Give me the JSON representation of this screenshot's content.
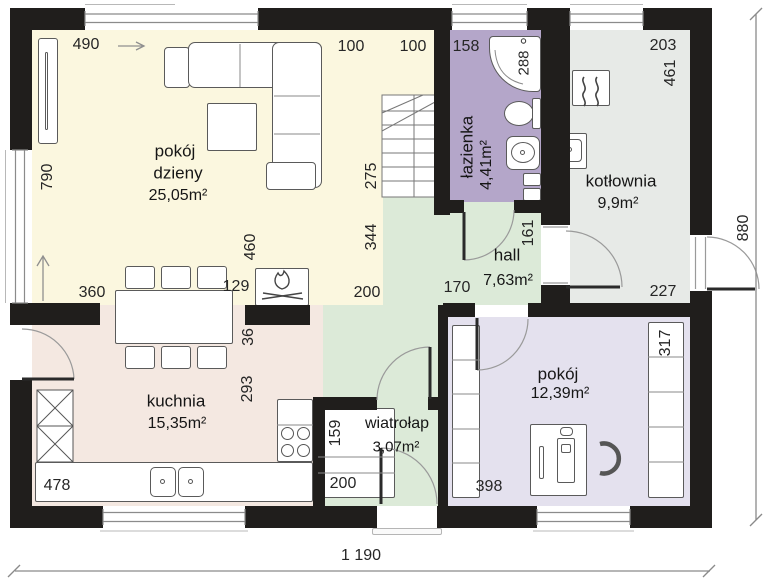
{
  "colors": {
    "wall": "#201e1c",
    "living": "#fbf7df",
    "kitchen": "#f4e8e1",
    "hall": "#dcead8",
    "vestibule": "#dcead8",
    "bathroom": "#b4a6c9",
    "boiler_room": "#e7eae7",
    "bedroom": "#e4e1ee",
    "furniture_outline": "#5a5a5a"
  },
  "rooms": {
    "living": {
      "name_line1": "pokój",
      "name_line2": "dzieny",
      "area": "25,05m²"
    },
    "kitchen": {
      "name": "kuchnia",
      "area": "15,35m²"
    },
    "bathroom": {
      "name": "łazienka",
      "area": "4,41m²"
    },
    "boiler_room": {
      "name": "kotłownia",
      "area": "9,9m²"
    },
    "hall": {
      "name": "hall",
      "area": "7,63m²"
    },
    "vestibule": {
      "name": "wiatrołap",
      "area": "3,07m²"
    },
    "bedroom": {
      "name": "pokój",
      "area": "12,39m²"
    }
  },
  "dimensions": {
    "d490": "490",
    "d790": "790",
    "d100a": "100",
    "d100b": "100",
    "d158": "158",
    "d288": "288",
    "d203": "203",
    "d461": "461",
    "d275": "275",
    "d344": "344",
    "d460": "460",
    "d129": "129",
    "d360": "360",
    "d200_hall": "200",
    "d161": "161",
    "d880": "880",
    "d227": "227",
    "d170": "170",
    "d36": "36",
    "d293": "293",
    "d317": "317",
    "d159": "159",
    "d200_closet": "200",
    "d478": "478",
    "d398": "398",
    "d1190_total": "1 190"
  }
}
